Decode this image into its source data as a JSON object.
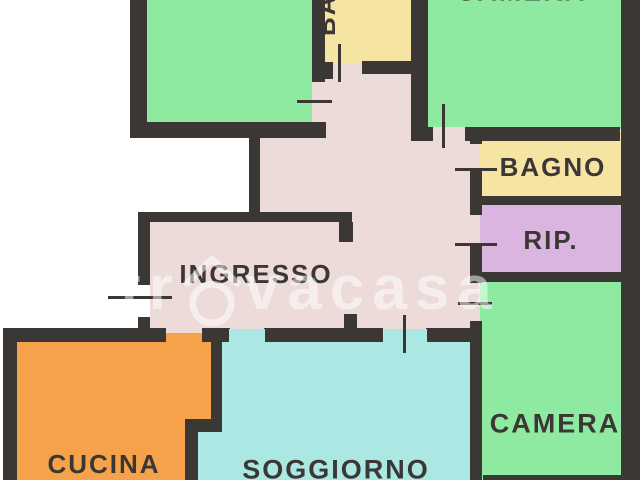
{
  "floorplan": {
    "type": "apartment-floor-plan",
    "rooms": {
      "camera_top_left": {
        "label": "",
        "color": "#8ee9a1"
      },
      "camera_top": {
        "label": "CAMERA",
        "color": "#8ee9a1"
      },
      "bagno_top": {
        "label": "BAGNO",
        "color": "#f6e4a3",
        "orientation": "vertical",
        "note": "cut off at top edge, only last letters visible"
      },
      "bagno": {
        "label": "BAGNO",
        "color": "#f6e4a3"
      },
      "rip": {
        "label": "RIP.",
        "color": "#dab5df"
      },
      "ingresso": {
        "label": "INGRESSO",
        "color": "#eddbd9"
      },
      "cucina": {
        "label": "CUCINA",
        "color": "#f6a24a"
      },
      "soggiorno": {
        "label": "SOGGIORNO",
        "color": "#abe8e4"
      },
      "camera_bottom": {
        "label": "CAMERA",
        "color": "#8ee9a1"
      }
    },
    "wall_color": "#3b3735",
    "label_color": "#3b3735",
    "background_color": "#ffffff"
  },
  "watermark": {
    "prefix": "tr",
    "suffix": "vacasa",
    "full_text": "trovacasa",
    "color": "rgba(255,255,255,0.52)"
  }
}
